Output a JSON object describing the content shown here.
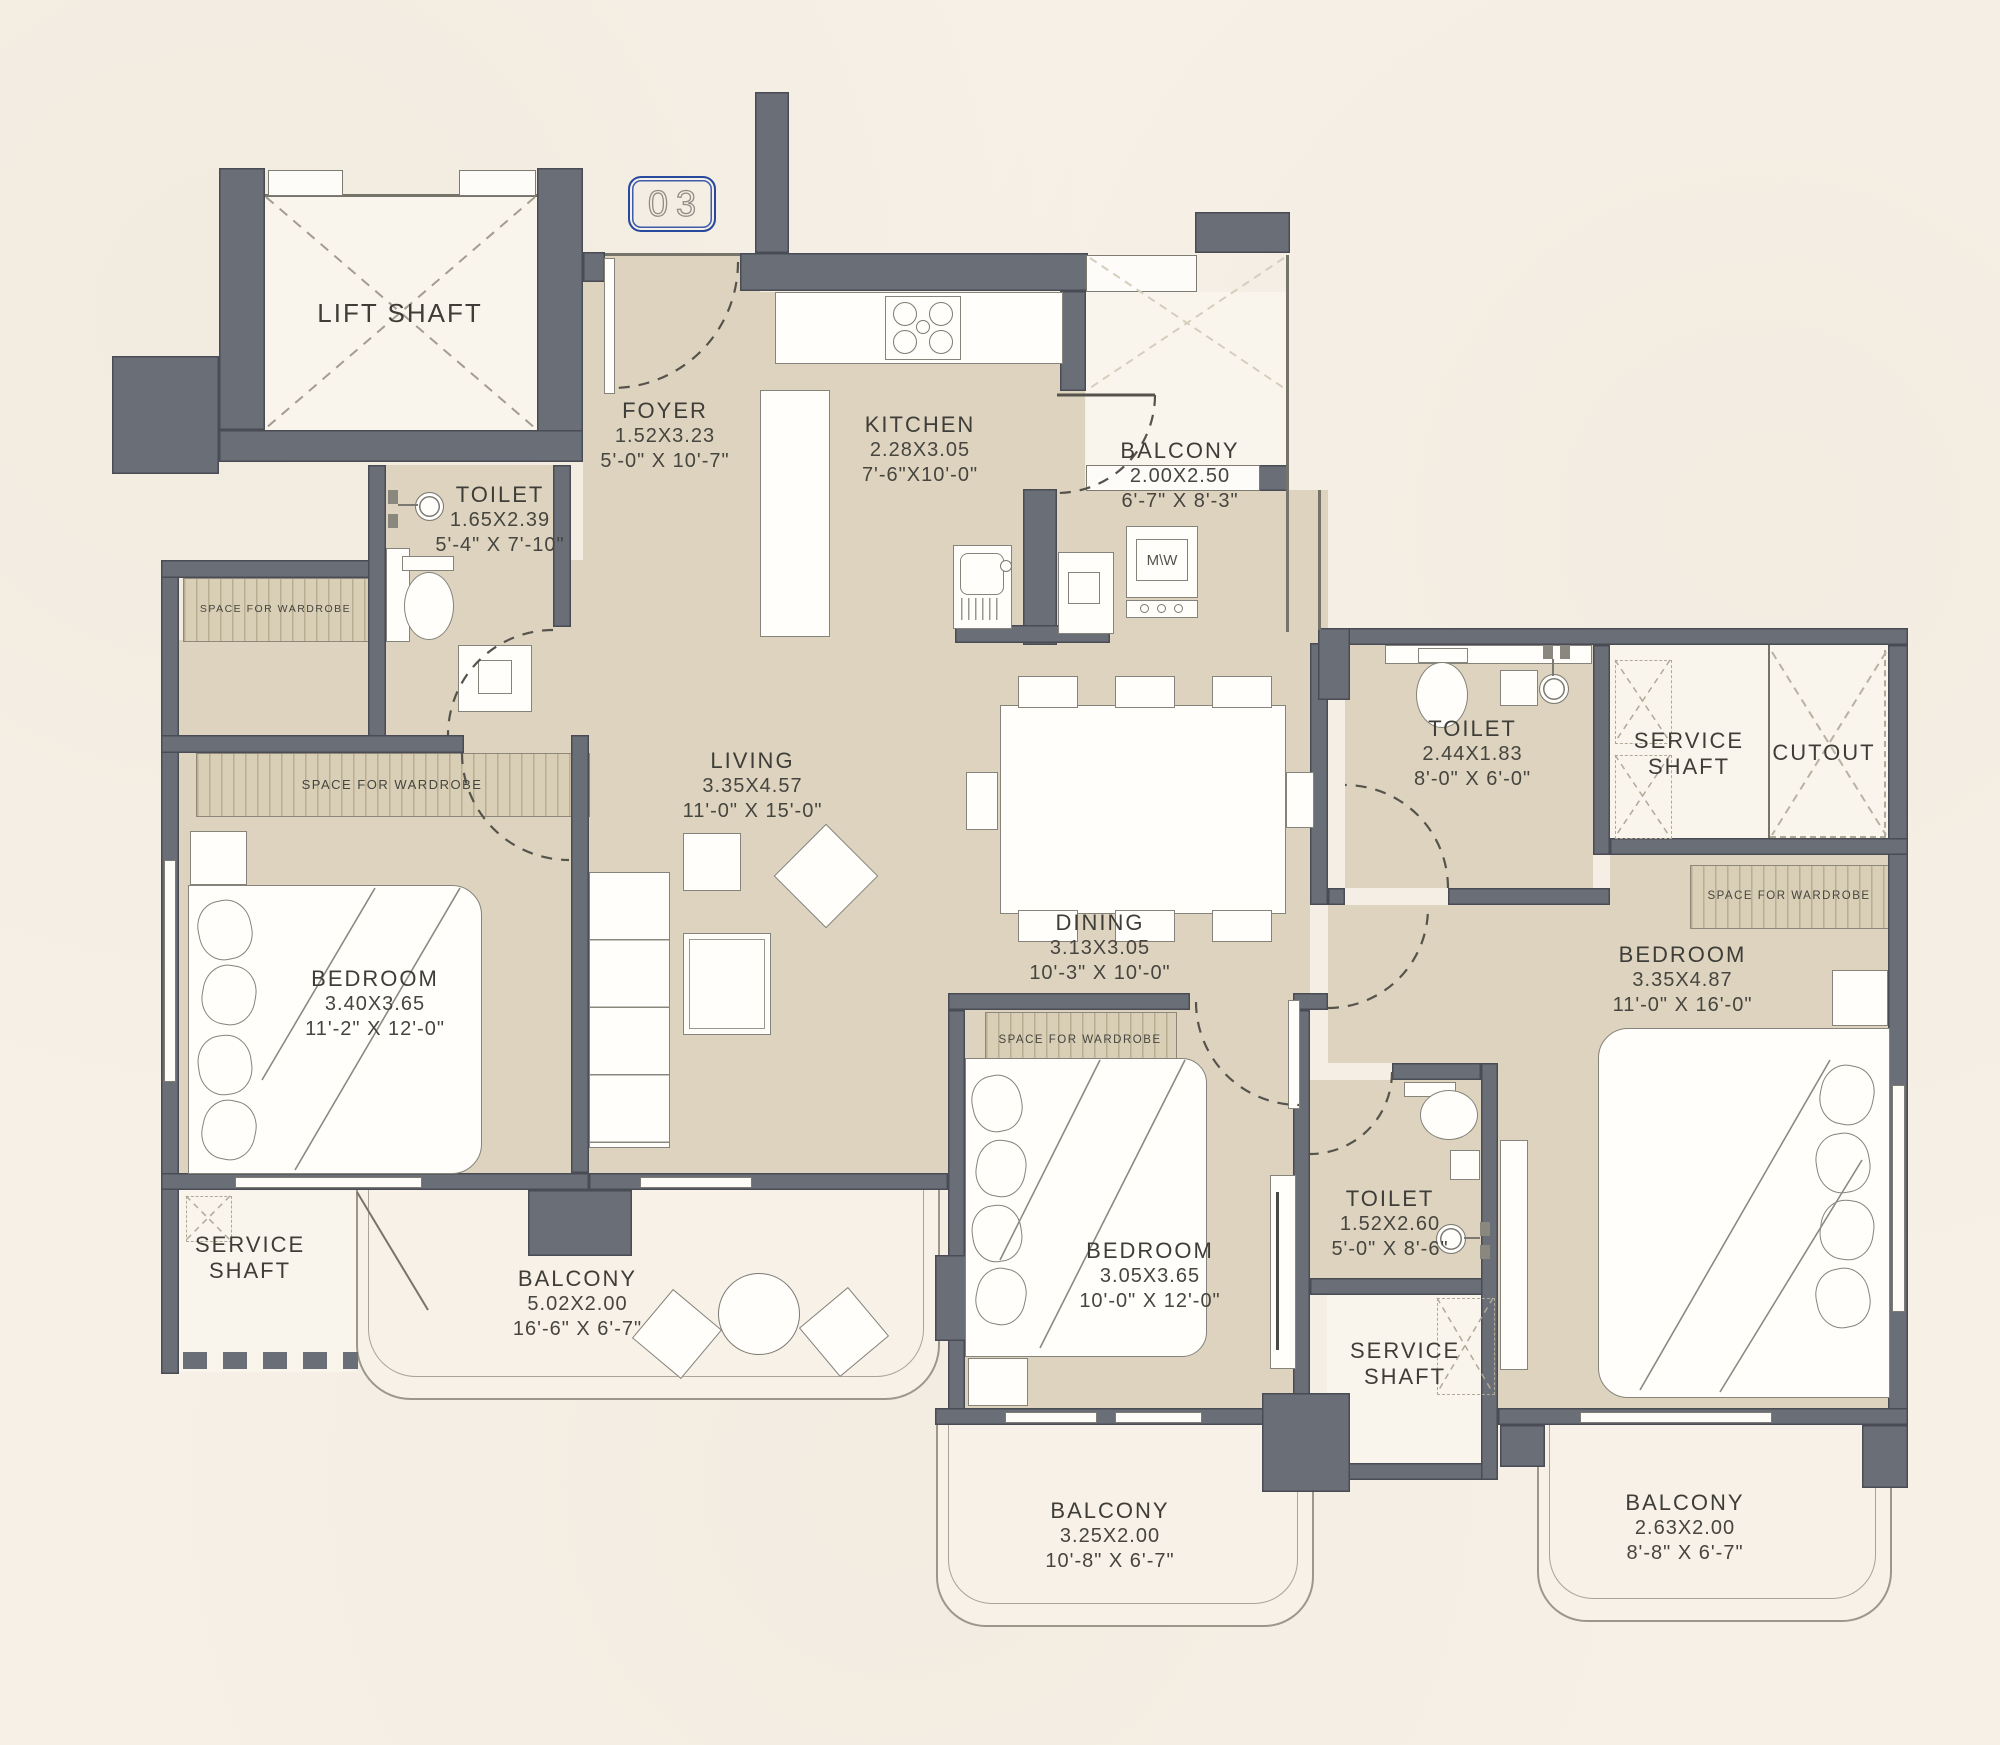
{
  "unit_badge": "03",
  "labels": {
    "wardrobe": "SPACE FOR WARDROBE",
    "microwave": "M\\W"
  },
  "rooms": {
    "lift_shaft": {
      "name": "LIFT SHAFT"
    },
    "foyer": {
      "name": "FOYER",
      "m": "1.52X3.23",
      "ft": "5'-0\" X 10'-7\""
    },
    "kitchen": {
      "name": "KITCHEN",
      "m": "2.28X3.05",
      "ft": "7'-6\"X10'-0\""
    },
    "balcony_top": {
      "name": "BALCONY",
      "m": "2.00X2.50",
      "ft": "6'-7\" X 8'-3\""
    },
    "toilet_top_left": {
      "name": "TOILET",
      "m": "1.65X2.39",
      "ft": "5'-4\" X 7'-10\""
    },
    "living": {
      "name": "LIVING",
      "m": "3.35X4.57",
      "ft": "11'-0\" X 15'-0\""
    },
    "dining": {
      "name": "DINING",
      "m": "3.13X3.05",
      "ft": "10'-3\" X 10'-0\""
    },
    "bedroom_left": {
      "name": "BEDROOM",
      "m": "3.40X3.65",
      "ft": "11'-2\" X 12'-0\""
    },
    "bedroom_middle": {
      "name": "BEDROOM",
      "m": "3.05X3.65",
      "ft": "10'-0\" X 12'-0\""
    },
    "bedroom_right": {
      "name": "BEDROOM",
      "m": "3.35X4.87",
      "ft": "11'-0\" X 16'-0\""
    },
    "toilet_right": {
      "name": "TOILET",
      "m": "2.44X1.83",
      "ft": "8'-0\" X 6'-0\""
    },
    "toilet_middle": {
      "name": "TOILET",
      "m": "1.52X2.60",
      "ft": "5'-0\" X 8'-6\""
    },
    "service_shaft_left": {
      "name": "SERVICE SHAFT"
    },
    "service_shaft_middle": {
      "name": "SERVICE SHAFT"
    },
    "service_shaft_right": {
      "name": "SERVICE SHAFT"
    },
    "cutout": {
      "name": "CUTOUT"
    },
    "balcony_bottom_left": {
      "name": "BALCONY",
      "m": "5.02X2.00",
      "ft": "16'-6\" X 6'-7\""
    },
    "balcony_bottom_middle": {
      "name": "BALCONY",
      "m": "3.25X2.00",
      "ft": "10'-8\" X 6'-7\""
    },
    "balcony_bottom_right": {
      "name": "BALCONY",
      "m": "2.63X2.00",
      "ft": "8'-8\" X 6'-7\""
    }
  },
  "colors": {
    "wall": "#6a6e77",
    "floor": "#ddd3bf",
    "background": "#f6f0e7",
    "badge_border": "#274a9e"
  }
}
